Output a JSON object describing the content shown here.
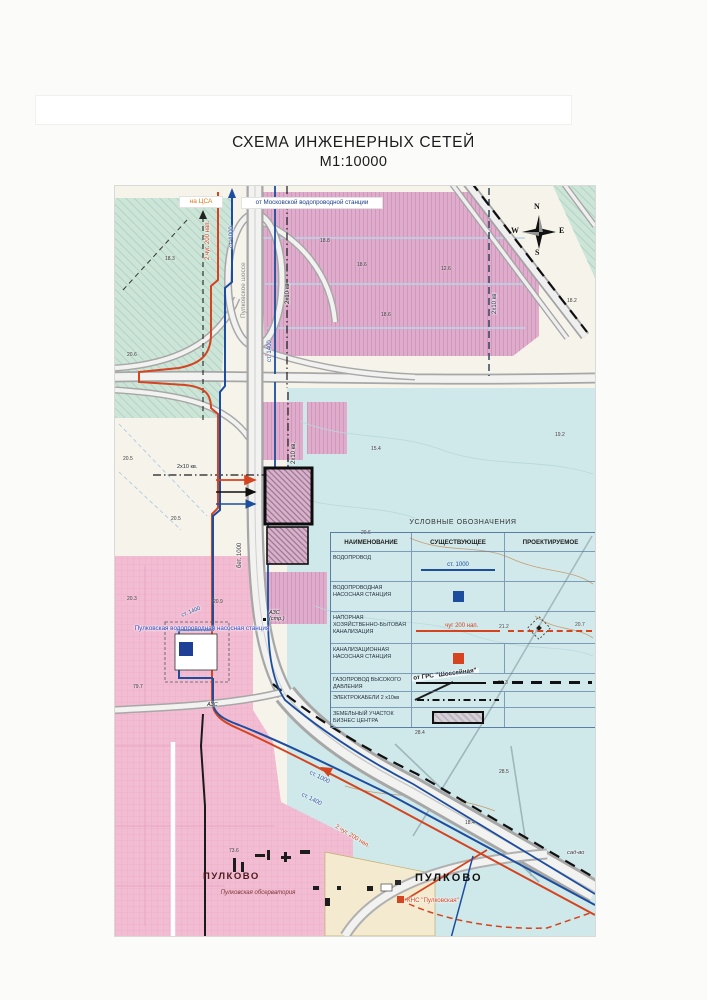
{
  "page": {
    "title": "СХЕМА ИНЖЕНЕРНЫХ СЕТЕЙ",
    "scale": "М1:10000"
  },
  "map": {
    "labels": {
      "na_csa": "на ЦСА",
      "from_moscow": "от Московской водопроводной станции",
      "sewer_top": "2 чуг. 200 нап.",
      "water_top": "ст. 1000",
      "road_name": "Пулковское шоссе",
      "cable_top": "2х10 кв",
      "cable_right": "2х10 кв",
      "cable_v": "2х10 кв.",
      "cable_h": "2х10 кв.",
      "water_1400": "ст. 1400",
      "water_bet": "бет. 1000",
      "water_1400_st": "ст. 1400",
      "pump_station": "Пулковская водопроводная насосная станция",
      "from_grs": "от ГРС \"Шоссейная\"",
      "azs_constr": "АЗС (стр.)",
      "azs": "АЗС",
      "water_1000_hwy": "ст. 1000",
      "water_1400_hwy": "ст. 1400",
      "sewer_hwy": "2 чуг. 200 нап.",
      "pulkovo_w": "ПУЛКОВО",
      "observatory": "Пулковская обсерватория",
      "pulkovo_e": "ПУЛКОВО",
      "kns": "КНС \"Пулковская\"",
      "sadvo": "сад-во"
    },
    "compass": {
      "n": "N",
      "w": "W",
      "e": "E",
      "s": "S"
    },
    "spot_elevations": [
      {
        "v": "18.3",
        "x": 50,
        "y": 70
      },
      {
        "v": "20.6",
        "x": 12,
        "y": 166
      },
      {
        "v": "18.8",
        "x": 205,
        "y": 52
      },
      {
        "v": "18.6",
        "x": 242,
        "y": 76
      },
      {
        "v": "12.6",
        "x": 326,
        "y": 80
      },
      {
        "v": "18.6",
        "x": 266,
        "y": 126
      },
      {
        "v": "18.2",
        "x": 452,
        "y": 112
      },
      {
        "v": "19.2",
        "x": 440,
        "y": 246
      },
      {
        "v": "15.4",
        "x": 256,
        "y": 260
      },
      {
        "v": "20.5",
        "x": 8,
        "y": 270
      },
      {
        "v": "20.5",
        "x": 56,
        "y": 330
      },
      {
        "v": "20.3",
        "x": 12,
        "y": 410
      },
      {
        "v": "20.9",
        "x": 98,
        "y": 413
      },
      {
        "v": "20.6",
        "x": 246,
        "y": 344
      },
      {
        "v": "21.2",
        "x": 384,
        "y": 438
      },
      {
        "v": "20.7",
        "x": 460,
        "y": 436
      },
      {
        "v": "20.3",
        "x": 383,
        "y": 494
      },
      {
        "v": "28.4",
        "x": 300,
        "y": 544
      },
      {
        "v": "28.5",
        "x": 384,
        "y": 583
      },
      {
        "v": "18.4",
        "x": 350,
        "y": 634
      },
      {
        "v": "73.6",
        "x": 114,
        "y": 662
      },
      {
        "v": "79.7",
        "x": 18,
        "y": 498
      }
    ]
  },
  "legend": {
    "title": "УСЛОВНЫЕ ОБОЗНАЧЕНИЯ",
    "col_name": "НАИМЕНОВАНИЕ",
    "col_existing": "СУЩЕСТВУЮЩЕЕ",
    "col_projected": "ПРОЕКТИРУЕМОЕ",
    "rows": [
      {
        "name": "ВОДОПРОВОД",
        "label": "ст. 1000"
      },
      {
        "name": "ВОДОПРОВОДНАЯ НАСОСНАЯ СТАНЦИЯ"
      },
      {
        "name": "НАПОРНАЯ ХОЗЯЙСТВЕННО-БЫТОВАЯ КАНАЛИЗАЦИЯ",
        "label": "чуг 200 нап."
      },
      {
        "name": "КАНАЛИЗАЦИОННАЯ НАСОСНАЯ СТАНЦИЯ"
      },
      {
        "name": "ГАЗОПРОВОД ВЫСОКОГО ДАВЛЕНИЯ"
      },
      {
        "name": "ЭЛЕКТРОКАБЕЛИ 2 х10кв"
      },
      {
        "name": "ЗЕМЕЛЬНЫЙ УЧАСТОК БИЗНЕС ЦЕНТРА"
      }
    ]
  },
  "colors": {
    "water": "#1d4e9e",
    "sewer": "#d5431f",
    "gas": "#111111",
    "cyan_field": "#cfe8ea",
    "pink_field": "#f2bcd2",
    "mauve_field": "#e0abca",
    "teal_field": "#cde5d8"
  }
}
